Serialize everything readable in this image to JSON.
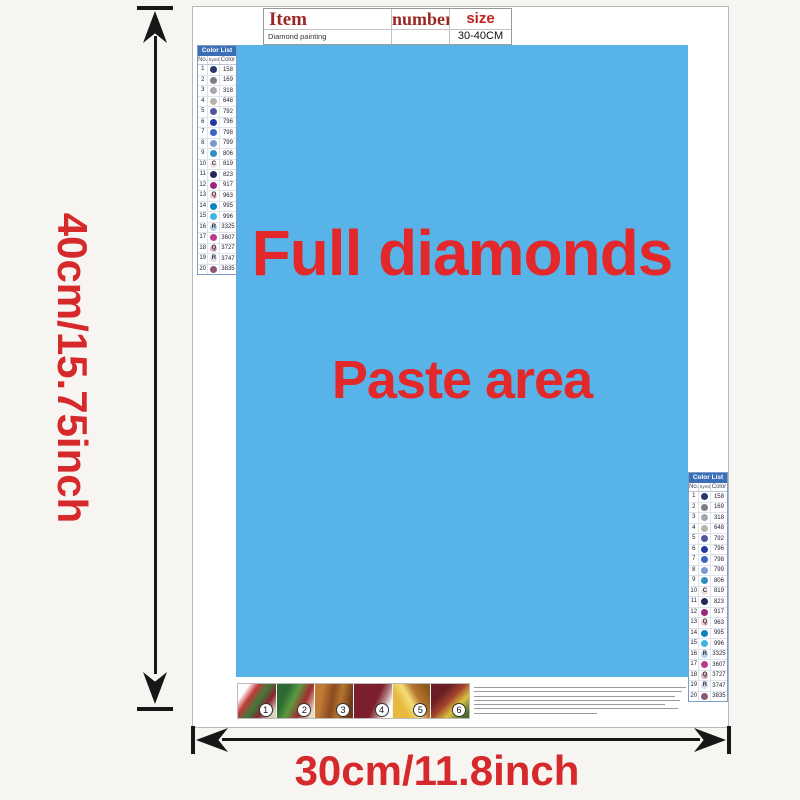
{
  "dimension_labels": {
    "height": "40cm/15.75inch",
    "width": "30cm/11.8inch",
    "text_color": "#d5292c"
  },
  "item_table": {
    "col_item": "Item",
    "col_number": "number",
    "col_size": "size",
    "product_name": "Diamond painting",
    "number_value": "",
    "size_value": "30-40CM"
  },
  "paste_area": {
    "title": "Full diamonds",
    "subtitle": "Paste area",
    "bg_color": "#58b4e8",
    "text_color": "#e2282b"
  },
  "color_list": {
    "title": "Color List",
    "col_no": "No.",
    "col_symbol": "Symbol",
    "col_color": "Color",
    "header_bg": "#3a6fb7",
    "rows": [
      {
        "no": "1",
        "sym": "",
        "code": "158",
        "dot": "#26386a"
      },
      {
        "no": "2",
        "sym": "",
        "code": "169",
        "dot": "#7d7d85"
      },
      {
        "no": "3",
        "sym": "",
        "code": "318",
        "dot": "#a5a7ae"
      },
      {
        "no": "4",
        "sym": "",
        "code": "648",
        "dot": "#b9b3a7"
      },
      {
        "no": "5",
        "sym": "",
        "code": "792",
        "dot": "#4d579e"
      },
      {
        "no": "6",
        "sym": "",
        "code": "796",
        "dot": "#2438a0"
      },
      {
        "no": "7",
        "sym": "",
        "code": "798",
        "dot": "#3c64c0"
      },
      {
        "no": "8",
        "sym": "",
        "code": "799",
        "dot": "#7d97d2"
      },
      {
        "no": "9",
        "sym": "",
        "code": "806",
        "dot": "#2f91bd"
      },
      {
        "no": "10",
        "sym": "C",
        "code": "819",
        "dot": "#f5dee1"
      },
      {
        "no": "11",
        "sym": "",
        "code": "823",
        "dot": "#202a54"
      },
      {
        "no": "12",
        "sym": "",
        "code": "917",
        "dot": "#9e2680"
      },
      {
        "no": "13",
        "sym": "Q",
        "code": "963",
        "dot": "#f4c9cf"
      },
      {
        "no": "14",
        "sym": "",
        "code": "995",
        "dot": "#0d83bb"
      },
      {
        "no": "15",
        "sym": "",
        "code": "996",
        "dot": "#41b5e2"
      },
      {
        "no": "16",
        "sym": "R",
        "code": "3325",
        "dot": "#b7d2ec"
      },
      {
        "no": "17",
        "sym": "",
        "code": "3607",
        "dot": "#bc3a88"
      },
      {
        "no": "18",
        "sym": "Q",
        "code": "3727",
        "dot": "#e0b1c3"
      },
      {
        "no": "19",
        "sym": "R",
        "code": "3747",
        "dot": "#d9dcf0"
      },
      {
        "no": "20",
        "sym": "",
        "code": "3835",
        "dot": "#8c5579"
      }
    ]
  },
  "steps": {
    "numbers": [
      "1",
      "2",
      "3",
      "4",
      "5",
      "6"
    ]
  }
}
